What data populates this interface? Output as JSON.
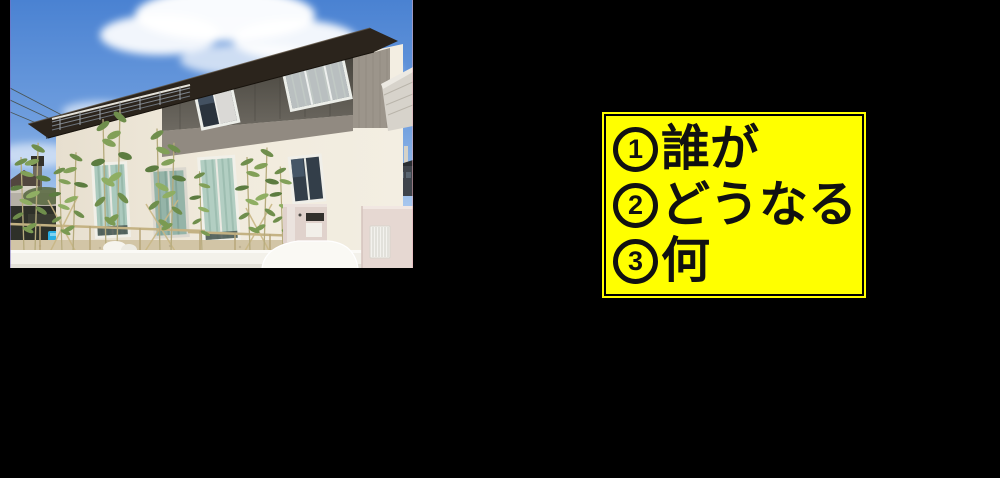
{
  "canvas": {
    "background": "#000000"
  },
  "photo": {
    "alt": "Exterior photo of a modern two-story house with dark gray upper siding, cream lower walls, bamboo plants and a white fence under a blue sky",
    "palette": {
      "sky": "#4a82d2",
      "cloud": "#ffffff",
      "roof": "#2b241c",
      "upper_siding": "#56524b",
      "mid_siding": "#918a81",
      "lower_wall": "#efe8d9",
      "curtains": "#abcabe",
      "fence": "#f3f1ea",
      "bamboo": "#6f8e4c",
      "pool": "#29aee4"
    }
  },
  "note": {
    "background_color": "#ffff00",
    "border_color": "#000000",
    "text_color": "#111111",
    "lines": [
      {
        "number": "1",
        "label": "誰が"
      },
      {
        "number": "2",
        "label": "どうなる"
      },
      {
        "number": "3",
        "label": "何"
      }
    ]
  }
}
